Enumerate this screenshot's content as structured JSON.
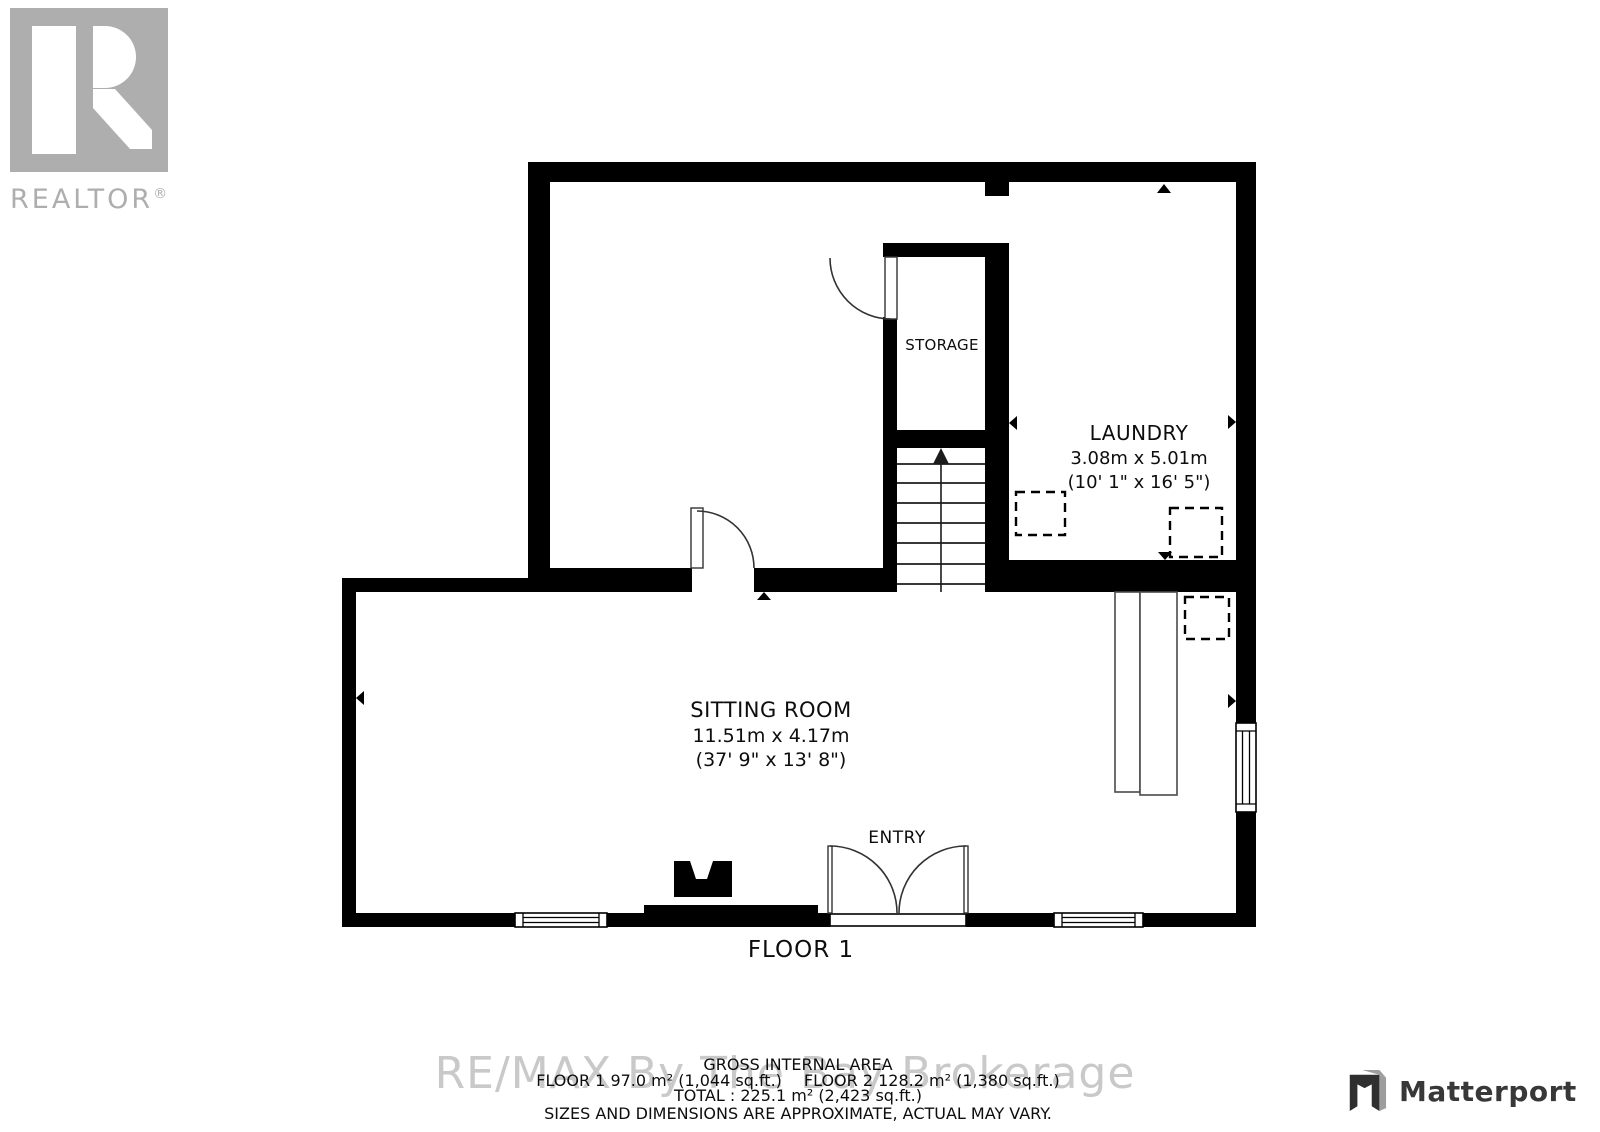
{
  "branding": {
    "realtor_text": "REALTOR",
    "realtor_reg": "®",
    "matterport_text": "Matterport"
  },
  "watermark": "RE/MAX By The Bay Brokerage",
  "rooms": {
    "storage": {
      "name": "STORAGE"
    },
    "laundry": {
      "name": "LAUNDRY",
      "dim_metric": "3.08m x 5.01m",
      "dim_imperial": "(10' 1\" x 16' 5\")"
    },
    "sitting_room": {
      "name": "SITTING ROOM",
      "dim_metric": "11.51m x 4.17m",
      "dim_imperial": "(37' 9\" x 13' 8\")"
    },
    "entry": {
      "name": "ENTRY"
    }
  },
  "floor_label": "FLOOR 1",
  "footer": {
    "title": "GROSS INTERNAL AREA",
    "floor1_area": "FLOOR 1 97.0 m² (1,044 sq.ft.)",
    "floor2_area": "FLOOR 2 128.2 m² (1,380 sq.ft.)",
    "total": "TOTAL :  225.1 m² (2,423 sq.ft.)",
    "disclaimer": "SIZES AND DIMENSIONS ARE APPROXIMATE, ACTUAL MAY VARY."
  },
  "colors": {
    "wall": "#000000",
    "door": "#333333",
    "furn": "#4a4a4a",
    "marker": "#000000",
    "watermark": "#c9c9c9",
    "realtor": "#aeaeae",
    "mp-dark": "#2f2f2f",
    "mp-light": "#9d9d9d",
    "mp-text": "#383838",
    "disclaimer": "#5a5a5a"
  }
}
